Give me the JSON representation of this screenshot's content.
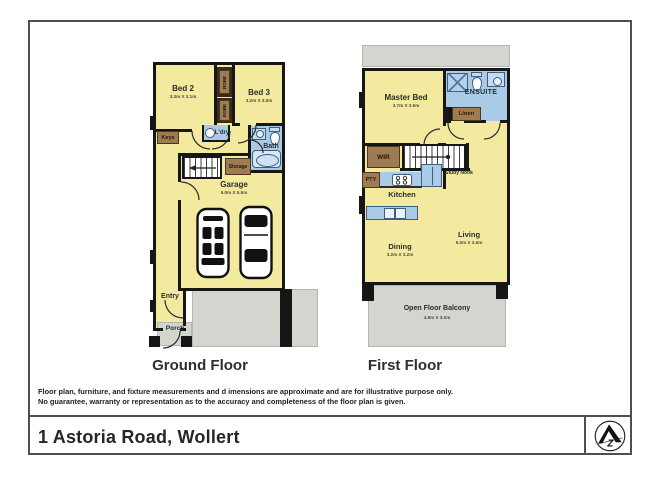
{
  "page": {
    "title": "1 Astoria Road, Wollert"
  },
  "disclaimer": {
    "line1": "Floor plan, furniture, and fixture measurements and d imensions are approximate and are for illustrative purpose only.",
    "line2": "No guarantee, warranty or representation as to the accuracy and completeness of the floor plan is given."
  },
  "logo": {
    "letter": "Z"
  },
  "ground_floor": {
    "label": "Ground Floor",
    "bed2": {
      "name": "Bed 2",
      "dims": "3.3m X 3.1m"
    },
    "bed3": {
      "name": "Bed 3",
      "dims": "3.2m X 3.0m"
    },
    "robe_top": {
      "name": "ROBE"
    },
    "robe_bottom": {
      "name": "ROBE"
    },
    "keys": {
      "name": "Keys"
    },
    "laundry": {
      "name": "L'dry"
    },
    "bath": {
      "name": "Bath"
    },
    "storage": {
      "name": "Storage"
    },
    "garage": {
      "name": "Garage",
      "dims": "6.0m X 5.5m"
    },
    "entry": {
      "name": "Entry"
    },
    "porch": {
      "name": "Porch"
    }
  },
  "first_floor": {
    "label": "First Floor",
    "master_bed": {
      "name": "Master Bed",
      "dims": "3.7m X 3.6m"
    },
    "ensuite": {
      "name": "ENSUITE"
    },
    "linen": {
      "name": "Linen"
    },
    "wir": {
      "name": "WIR"
    },
    "pty": {
      "name": "PTY"
    },
    "study_nook": {
      "name": "Study Nook"
    },
    "kitchen": {
      "name": "Kitchen"
    },
    "dining": {
      "name": "Dining",
      "dims": "3.2m X 3.2m"
    },
    "living": {
      "name": "Living",
      "dims": "5.0m X 3.6m"
    },
    "balcony": {
      "name": "Open Floor Balcony",
      "dims": "4.9m X 3.0m"
    }
  },
  "colors": {
    "room_fill": "#F3EA9F",
    "wet_area_fill": "#A9CBE6",
    "fixture_fill": "#C6DCEE",
    "cabinet_fill": "#9D7C52",
    "dark_cabinet_fill": "#3A2B1A",
    "outdoor_fill": "#D3D6CE",
    "wall": "#161616",
    "frame_border": "#4F4F4F"
  }
}
